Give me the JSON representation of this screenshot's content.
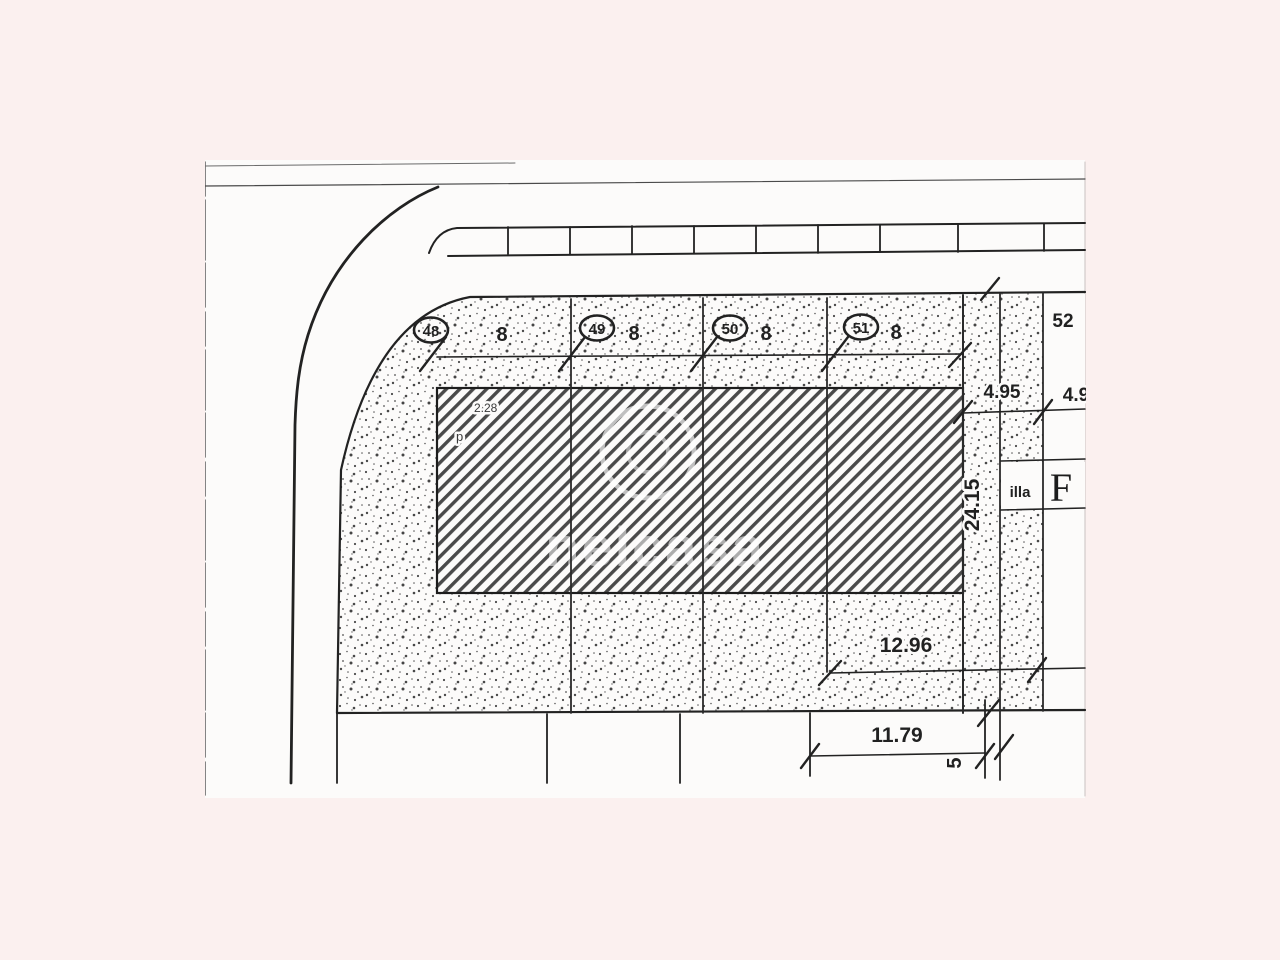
{
  "document": {
    "type": "cadastral-site-plan-scan",
    "paper_color": "#fcfbfa",
    "margin_color": "#fbf0ef",
    "ink_color": "#222222"
  },
  "watermark": {
    "text": "nelcasa"
  },
  "parcels": [
    {
      "id": "48",
      "width_label": "8"
    },
    {
      "id": "49",
      "width_label": "8"
    },
    {
      "id": "50",
      "width_label": "8"
    },
    {
      "id": "51",
      "width_label": "8"
    },
    {
      "id": "52",
      "width_label": ""
    }
  ],
  "zone": {
    "block_label": "illa",
    "block_letter": "F"
  },
  "dimensions": {
    "frontage_right": "4.95",
    "frontage_52": "4.9",
    "depth": "24.15",
    "building_offset": "2.28",
    "building_mark": "p",
    "rear_width": "12.96",
    "rear_frontage": "11.79",
    "side_gap": "5"
  }
}
